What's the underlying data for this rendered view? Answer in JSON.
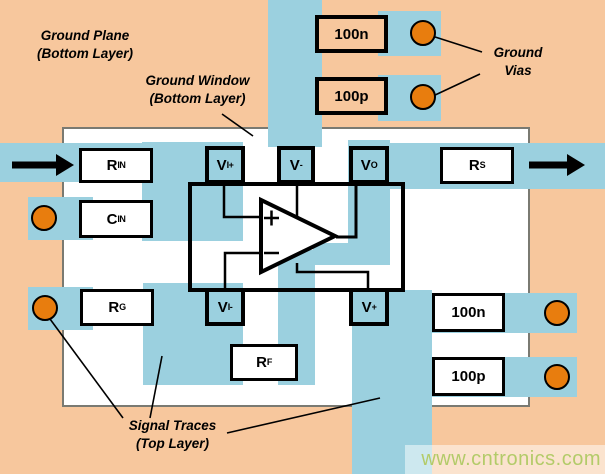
{
  "colors": {
    "background_peach": "#F7C79D",
    "trace_blue": "#9BD0DF",
    "via_orange": "#E87D0E",
    "watermark_green": "#B3CB69",
    "board_border_gray": "#7A7A72"
  },
  "annotations": {
    "ground_plane": {
      "line1": "Ground Plane",
      "line2": "(Bottom Layer)"
    },
    "ground_window": {
      "line1": "Ground Window",
      "line2": "(Bottom Layer)"
    },
    "ground_vias": {
      "line1": "Ground",
      "line2": "Vias"
    },
    "signal_traces": {
      "line1": "Signal Traces",
      "line2": "(Top Layer)"
    }
  },
  "components": {
    "cap_top_100n": {
      "label": "100n"
    },
    "cap_top_100p": {
      "label": "100p"
    },
    "r_in": {
      "main": "R",
      "sub": "IN"
    },
    "c_in": {
      "main": "C",
      "sub": "IN"
    },
    "r_g": {
      "main": "R",
      "sub": "G"
    },
    "r_f": {
      "main": "R",
      "sub": "F"
    },
    "r_s": {
      "main": "R",
      "sub": "S"
    },
    "cap_bot_100n": {
      "label": "100n"
    },
    "cap_bot_100p": {
      "label": "100p"
    }
  },
  "ic_pads": {
    "v_in_plus": {
      "main": "V",
      "sub": "I+"
    },
    "v_minus": {
      "main": "V",
      "sub": "-"
    },
    "v_out": {
      "main": "V",
      "sub": "O"
    },
    "v_in_minus": {
      "main": "V",
      "sub": "I-"
    },
    "v_plus": {
      "main": "V",
      "sub": "+"
    }
  },
  "opamp": {
    "plus_input_sign": "+",
    "minus_input_sign": "−"
  },
  "watermark": {
    "text": "www.cntronics.com"
  }
}
